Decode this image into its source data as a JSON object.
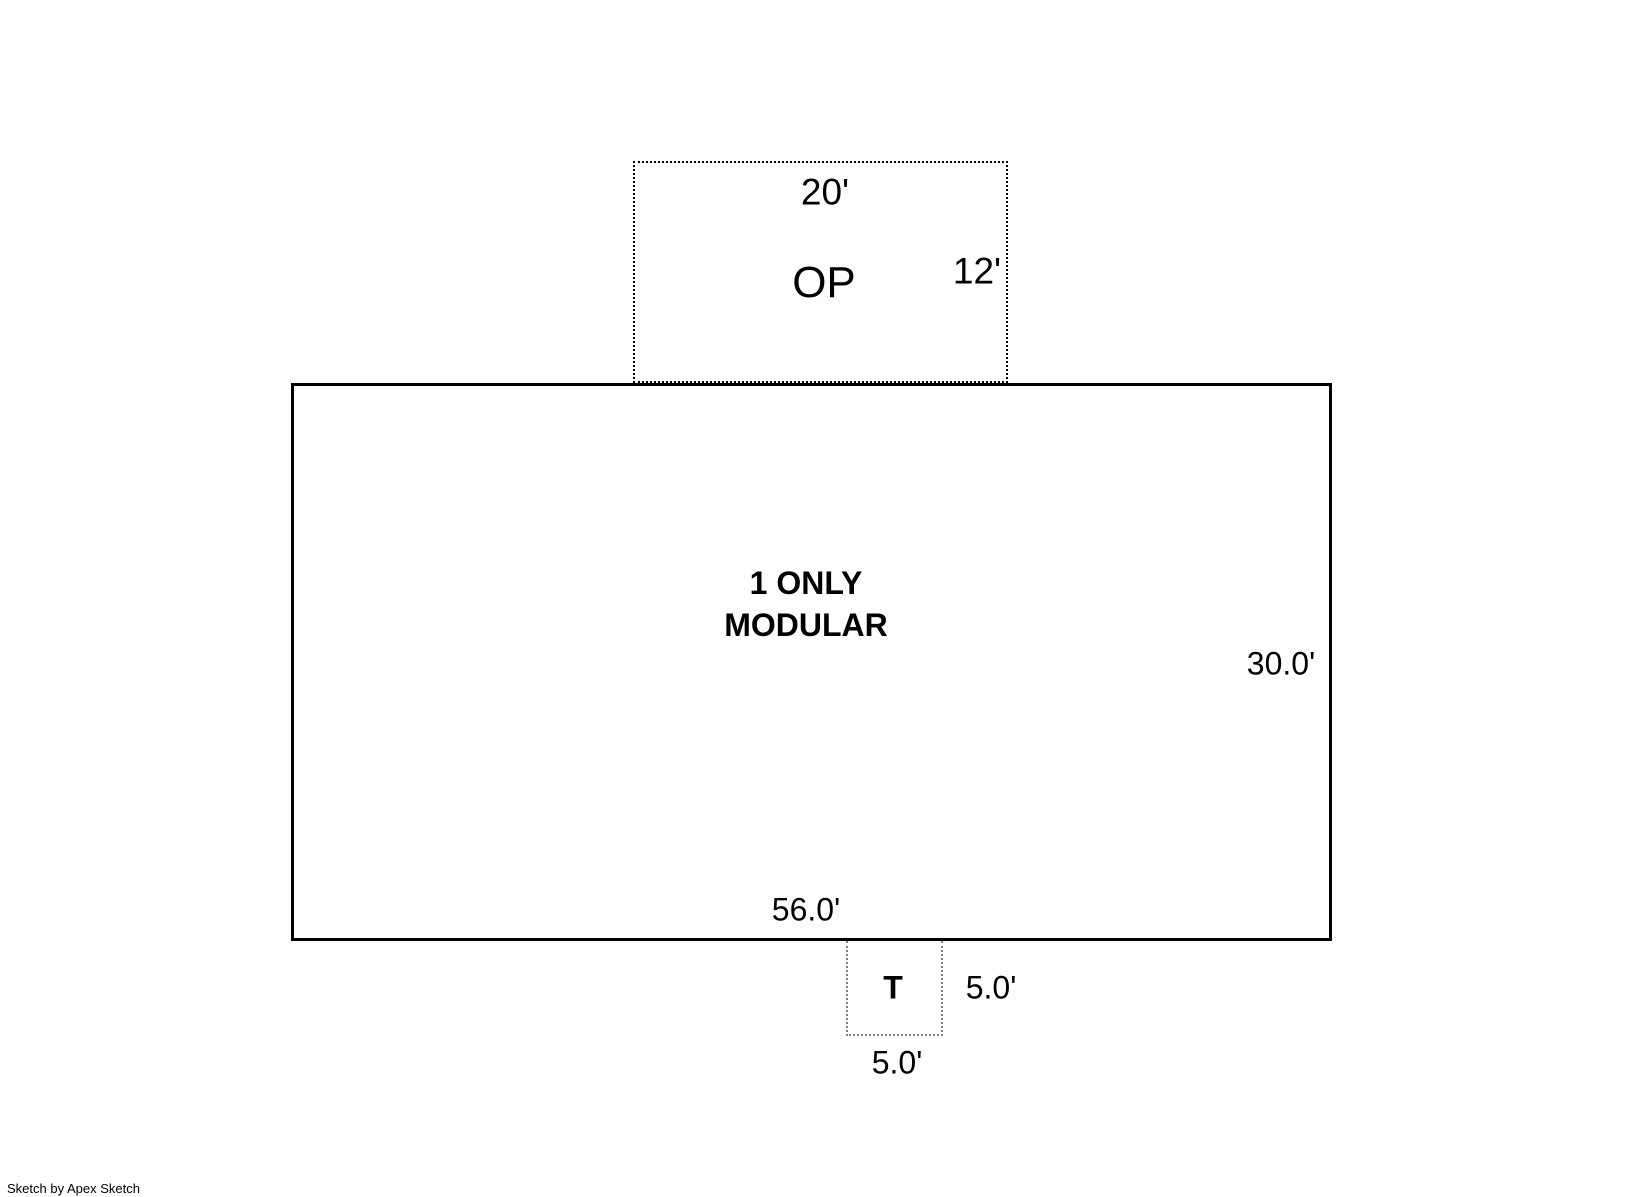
{
  "areas": {
    "op": {
      "label": "OP",
      "width_label": "20'",
      "height_label": "12'"
    },
    "modular": {
      "name_line1": "1 ONLY",
      "name_line2": "MODULAR",
      "width_label": "56.0'",
      "height_label": "30.0'"
    },
    "t": {
      "label": "T",
      "height_label": "5.0'",
      "width_label": "5.0'"
    }
  },
  "footer": {
    "credit": "Sketch by Apex Sketch"
  },
  "colors": {
    "background": "#ffffff",
    "main_outline": "#000000",
    "op_outline_dotted": "#000000",
    "t_outline_dotted": "#808080",
    "text": "#000000"
  }
}
